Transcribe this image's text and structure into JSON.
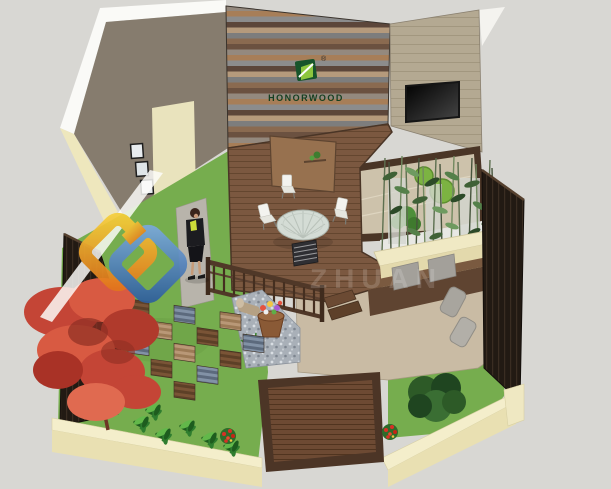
{
  "page": {
    "kind": "3d-garden-design-render",
    "background_color": "#d8d7d3"
  },
  "branding": {
    "logo_text": "HONORWOOD",
    "registered_mark": "®",
    "emblem_dark_green": "#17542b",
    "emblem_light_green": "#8dc63f",
    "logo_text_color": "#153f20"
  },
  "watermark": {
    "visible_text_fragment": "ZHUAN",
    "ribbon_color": "#ffffff",
    "diamond_gold_from": "#f6cf3a",
    "diamond_gold_to": "#e2761b",
    "diamond_blue_from": "#7aa8dc",
    "diamond_blue_to": "#2f5f9e"
  },
  "palette": {
    "wall_taupe": "#867c6e",
    "wall_beige": "#b4a992",
    "door_cream": "#e9e3bd",
    "deck_brown": "#7b5840",
    "platform_brown": "#6d4a33",
    "grass_green": "#76ad4e",
    "zen_sand": "#cdc2ab",
    "moss_green": "#7cb342",
    "curb_cream": "#f2ecc8",
    "fence_dark": "#221a13",
    "maple_red": "#c44536",
    "tile_slate": "#5c6a7d",
    "paving_tan": "#c9bba4",
    "tv_black": "#111111",
    "cushion_gray": "#a3a09a"
  },
  "scene": {
    "objects": [
      "taupe-back-wall",
      "door-panel",
      "framed-pictures",
      "wood-plank-wall",
      "honorwood-logo",
      "beige-side-wall",
      "wall-mounted-tv",
      "zen-gravel-garden",
      "moss-circles",
      "bamboo-planter",
      "bamboo-grove",
      "bench-with-cushions",
      "lounge-pillows",
      "round-glass-table",
      "white-chairs",
      "privacy-screen",
      "deck-railing",
      "deck-steps",
      "flower-pot",
      "gravel-bed",
      "checkerboard-deck-tiles",
      "lawn",
      "wooden-platform",
      "leafy-shrubs",
      "red-flower-bushes",
      "japanese-red-maple",
      "evergreen-shrub",
      "dark-wood-fence",
      "cream-garden-curb",
      "woman-figure",
      "watermark-logo"
    ]
  }
}
